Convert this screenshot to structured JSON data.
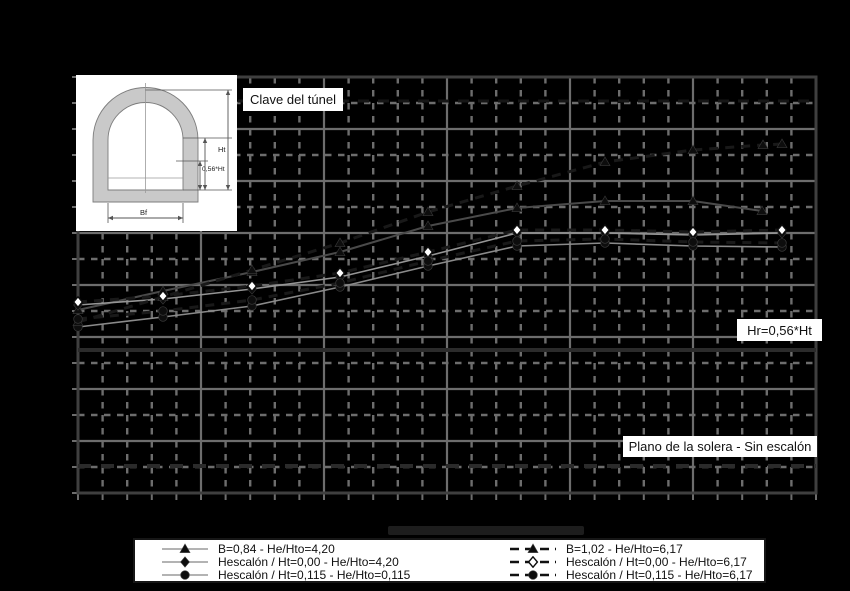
{
  "inset": {
    "title_label": "Clave del túnel",
    "dim_ht": "Ht",
    "dim_056ht": "0,56*Ht",
    "dim_bf": "Bf"
  },
  "annotations": {
    "hr_label": "Hr=0,56*Ht",
    "solera_label": "Plano de la solera - Sin escalón"
  },
  "colors": {
    "background": "#000000",
    "grid": "#6d6d6d",
    "frame": "#3f3f3f",
    "solid_series_line": "#929292",
    "dashed_series_line": "#191919",
    "marker": "#0d0d0d",
    "label_box_bg": "#ffffff",
    "label_text": "#111111"
  },
  "chart_data": {
    "type": "line",
    "title": "",
    "xlabel": "",
    "ylabel": "",
    "x_tick_labels": [],
    "y_tick_labels": [],
    "units": "screen pixel coordinates (y grows downward); no numeric axis labels are visible in the image",
    "plot_area_px": {
      "x0": 78,
      "y0": 77,
      "x1": 816,
      "y1": 493
    },
    "grid": {
      "x_major_px": 123,
      "x_minor_px": 24.6,
      "y_major_px": 52,
      "y_minor_px": 26,
      "style": "major solid / minor dashed, gray on black"
    },
    "reference_lines": [
      {
        "name": "Clave del túnel",
        "y_px": 101,
        "style": "dashed-dark"
      },
      {
        "name": "Hr=0,56*Ht",
        "y_px": 350,
        "style": "solid-dark-thick"
      },
      {
        "name": "Plano de la solera - Sin escalón",
        "y_px": 466,
        "style": "dashed-dark-thick"
      }
    ],
    "series": [
      {
        "name": "B=0,84 - He/Hto=4,20",
        "line": "solid",
        "marker": "triangle-filled",
        "line_color": "#4a4a4a",
        "line_width": 2,
        "points_px": [
          [
            78,
            310
          ],
          [
            163,
            291
          ],
          [
            252,
            272
          ],
          [
            340,
            252
          ],
          [
            428,
            226
          ],
          [
            517,
            208
          ],
          [
            605,
            201
          ],
          [
            693,
            201
          ],
          [
            762,
            211
          ]
        ]
      },
      {
        "name": "Hescalón / Ht=0,00 - He/Hto=4,20",
        "line": "solid",
        "marker": "diamond-filled",
        "line_color": "#959595",
        "line_width": 1.6,
        "points_px": [
          [
            78,
            305
          ],
          [
            163,
            299
          ],
          [
            252,
            289
          ],
          [
            340,
            277
          ],
          [
            428,
            256
          ],
          [
            517,
            233
          ],
          [
            605,
            233
          ],
          [
            693,
            235
          ],
          [
            782,
            233
          ]
        ]
      },
      {
        "name": "Hescalón / Ht=0,115 - He/Hto=0,115",
        "line": "solid",
        "marker": "circle-filled",
        "line_color": "#8a8a8a",
        "line_width": 1.6,
        "points_px": [
          [
            78,
            327
          ],
          [
            163,
            317
          ],
          [
            252,
            306
          ],
          [
            340,
            287
          ],
          [
            428,
            266
          ],
          [
            517,
            246
          ],
          [
            605,
            243
          ],
          [
            693,
            246
          ],
          [
            782,
            247
          ]
        ]
      },
      {
        "name": "B=1,02 - He/Hto=6,17",
        "line": "dashed",
        "marker": "triangle-filled",
        "line_color": "#191919",
        "line_width": 3,
        "points_px": [
          [
            78,
            322
          ],
          [
            163,
            297
          ],
          [
            252,
            270
          ],
          [
            340,
            243
          ],
          [
            428,
            212
          ],
          [
            517,
            186
          ],
          [
            605,
            162
          ],
          [
            693,
            150
          ],
          [
            763,
            145
          ],
          [
            782,
            144
          ]
        ]
      },
      {
        "name": "Hescalón / Ht=0,00 - He/Hto=6,17",
        "line": "dashed",
        "marker": "diamond-open",
        "line_color": "#191919",
        "line_width": 3,
        "points_px": [
          [
            78,
            302
          ],
          [
            163,
            296
          ],
          [
            252,
            286
          ],
          [
            340,
            273
          ],
          [
            428,
            252
          ],
          [
            517,
            230
          ],
          [
            605,
            230
          ],
          [
            693,
            232
          ],
          [
            782,
            230
          ]
        ]
      },
      {
        "name": "Hescalón / Ht=0,115 - He/Hto=6,17",
        "line": "dashed",
        "marker": "circle-filled",
        "line_color": "#191919",
        "line_width": 3,
        "points_px": [
          [
            78,
            319
          ],
          [
            163,
            311
          ],
          [
            252,
            300
          ],
          [
            340,
            283
          ],
          [
            428,
            261
          ],
          [
            517,
            241
          ],
          [
            605,
            239
          ],
          [
            693,
            242
          ],
          [
            782,
            243
          ]
        ]
      }
    ],
    "legend_position": "bottom-center, two columns, white box"
  }
}
